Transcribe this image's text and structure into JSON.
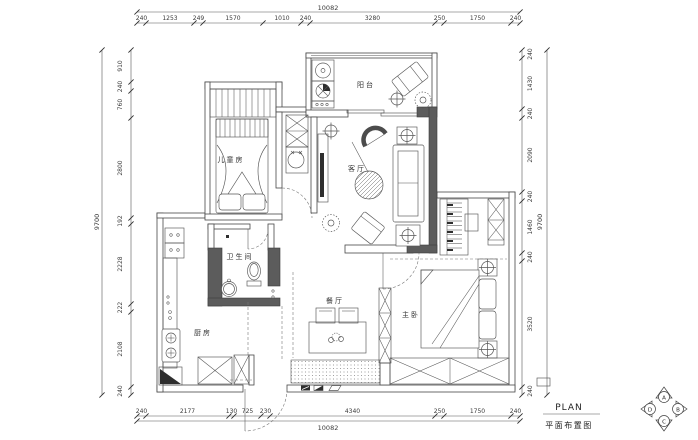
{
  "drawing": {
    "title_en": "PLAN",
    "title_zh": "平面布置图",
    "rooms": {
      "children_bedroom": "儿童房",
      "balcony": "阳台",
      "living_room": "客厅",
      "bathroom": "卫生间",
      "kitchen": "厨房",
      "dining_room": "餐厅",
      "master_bedroom": "主卧"
    },
    "elevation_markers": {
      "up": "A",
      "right": "B",
      "down": "C",
      "left": "D"
    },
    "dimensions": {
      "top": {
        "total": "10082",
        "segments": [
          "240",
          "1253",
          "249",
          "1570",
          "1010",
          "240",
          "3280",
          "250",
          "1750",
          "240"
        ]
      },
      "bottom": {
        "total": "10082",
        "segments": [
          "240",
          "2177",
          "130",
          "725",
          "230",
          "4340",
          "250",
          "1750",
          "240"
        ]
      },
      "left": {
        "total": "9700",
        "segments": [
          "910",
          "240",
          "760",
          "2800",
          "192",
          "2228",
          "222",
          "2108",
          "240"
        ]
      },
      "right": {
        "total": "9700",
        "segments": [
          "240",
          "1430",
          "240",
          "2090",
          "240",
          "1460",
          "240",
          "3520",
          "240"
        ]
      }
    },
    "colors": {
      "line": "#3f3f3f",
      "wall_fill": "#5c5c5c",
      "background": "#ffffff"
    }
  }
}
